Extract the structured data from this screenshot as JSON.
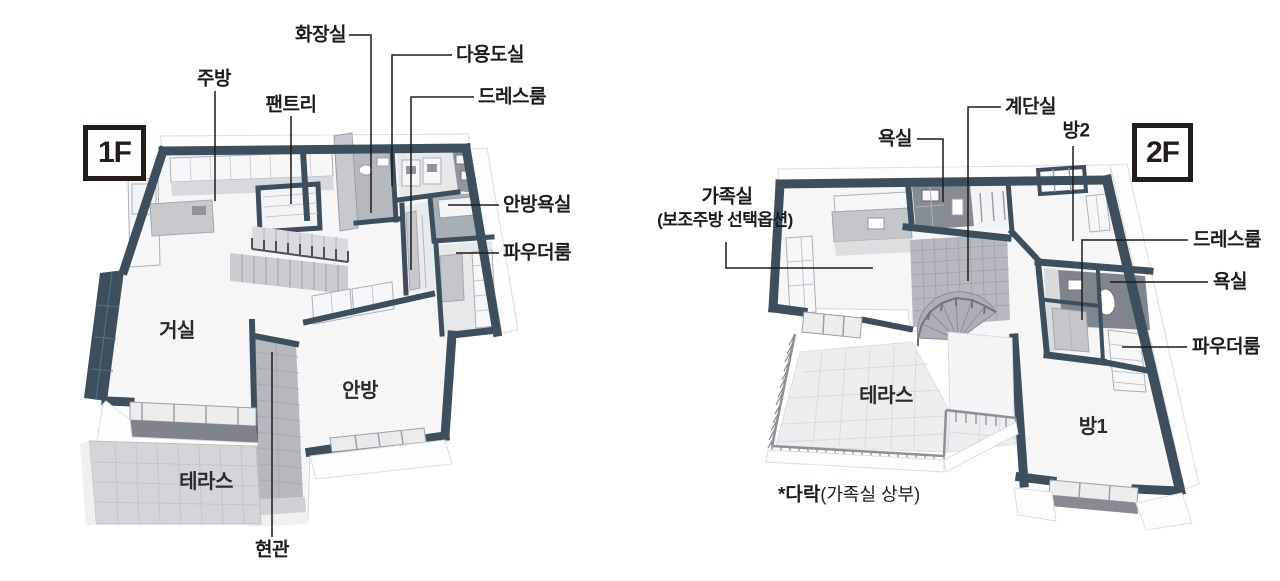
{
  "page": {
    "background": "#ffffff"
  },
  "colors": {
    "wall_navy": "#3d4f5d",
    "leader_line": "#1b1b1b",
    "badge_frame": "#241d19",
    "label_text": "#1c1c1e",
    "terrace_tile_1f": "#d3d6d8",
    "terrace_tile_2f": "#edeeef",
    "bath_tile_dark": "#7e858d"
  },
  "floor1": {
    "badge": "1F",
    "callouts": {
      "hwajangsil": "화장실",
      "dayongdosil": "다용도실",
      "dressroom": "드레스룸",
      "jubang": "주방",
      "pantry": "팬트리",
      "anbang_yoksil": "안방욕실",
      "powder": "파우더룸",
      "hyeongwan": "현관"
    },
    "rooms": {
      "geosil": "거실",
      "anbang": "안방",
      "terrace": "테라스"
    }
  },
  "floor2": {
    "badge": "2F",
    "callouts": {
      "gyedansil": "계단실",
      "yoksil_top": "욕실",
      "bang2": "방2",
      "gajoksil": "가족실",
      "gajoksil_option": "(보조주방 선택옵션)",
      "dressroom": "드레스룸",
      "yoksil_side": "욕실",
      "powder": "파우더룸"
    },
    "rooms": {
      "terrace": "테라스",
      "bang1": "방1"
    },
    "note": {
      "attic": "*다락",
      "attic_detail": "(가족실 상부)"
    }
  }
}
